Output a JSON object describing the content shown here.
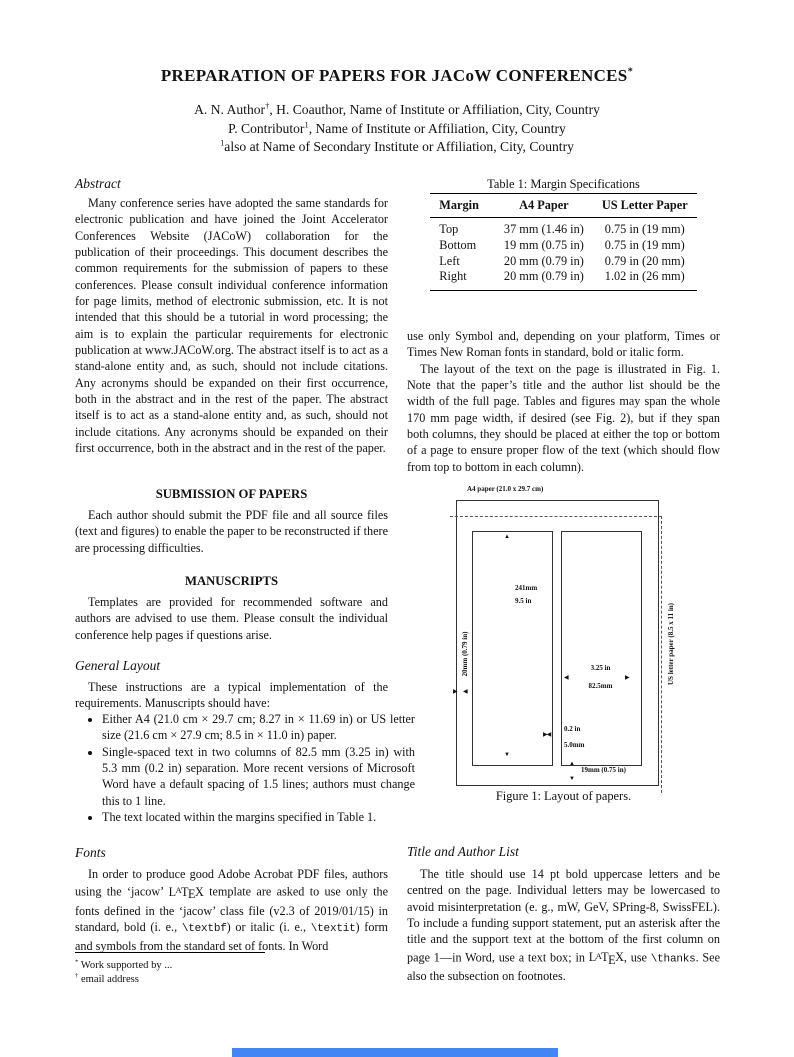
{
  "header": {
    "title": "PREPARATION OF PAPERS FOR JACoW CONFERENCES",
    "title_note": "*",
    "author_lines": [
      {
        "text": "A. N. Author",
        "sup": "†",
        "rest": ", H. Coauthor, Name of Institute or Affiliation, City, Country"
      },
      {
        "text": "P. Contributor",
        "sup": "1",
        "rest": ", Name of Institute or Affiliation, City, Country"
      },
      {
        "text": "",
        "sup": "1",
        "rest": "also at Name of Secondary Institute or Affiliation, City, Country"
      }
    ]
  },
  "left_column": {
    "abstract": {
      "heading": "Abstract",
      "body": "Many conference series have adopted the same standards for electronic publication and have joined the Joint Accelerator Conferences Website (JACoW) collaboration for the publication of their proceedings. This document describes the common requirements for the submission of papers to these conferences. Please consult individual conference information for page limits, method of electronic submission, etc. It is not intended that this should be a tutorial in word processing; the aim is to explain the particular requirements for electronic publication at www.JACoW.org. The abstract itself is to act as a stand-alone entity and, as such, should not include citations. Any acronyms should be expanded on their first occurrence, both in the abstract and in the rest of the paper. The abstract itself is to act as a stand-alone entity and, as such, should not include citations. Any acronyms should be expanded on their first occurrence, both in the abstract and in the rest of the paper."
    },
    "submission": {
      "heading": "SUBMISSION OF PAPERS",
      "body": "Each author should submit the PDF file and all source files (text and figures) to enable the paper to be reconstructed if there are processing difficulties."
    },
    "manuscripts": {
      "heading": "MANUSCRIPTS",
      "body": "Templates are provided for recommended software and authors are advised to use them. Please consult the individual conference help pages if questions arise."
    },
    "general_layout": {
      "heading": "General Layout",
      "intro": "These instructions are a typical implementation of the requirements. Manuscripts should have:",
      "bullets": [
        "Either A4 (21.0 cm × 29.7 cm; 8.27 in × 11.69 in) or US letter size (21.6 cm × 27.9 cm; 8.5 in × 11.0 in) paper.",
        "Single-spaced text in two columns of 82.5 mm (3.25 in) with 5.3 mm (0.2 in) separation. More recent versions of Microsoft Word have a default spacing of 1.5 lines; authors must change this to 1 line.",
        "The text located within the margins specified in Table 1."
      ]
    },
    "fonts": {
      "heading": "Fonts",
      "segments": [
        {
          "type": "text",
          "value": "In order to produce good Adobe Acrobat PDF files, authors using the ‘jacow’ "
        },
        {
          "type": "latex",
          "value": "LATEX"
        },
        {
          "type": "text",
          "value": " template are asked to use only the fonts defined in the ‘jacow’ class file (v2.3 of 2019/01/15) in standard, bold (i. e., "
        },
        {
          "type": "code",
          "value": "\\textbf"
        },
        {
          "type": "text",
          "value": ") or italic (i. e., "
        },
        {
          "type": "code",
          "value": "\\textit"
        },
        {
          "type": "text",
          "value": ") form and symbols from the standard set of fonts. In Word"
        }
      ]
    },
    "footnotes": [
      {
        "sup": "*",
        "text": "Work supported by ..."
      },
      {
        "sup": "†",
        "text": "email address"
      }
    ]
  },
  "right_column": {
    "table": {
      "caption": "Table 1: Margin Specifications",
      "headers": [
        "Margin",
        "A4 Paper",
        "US Letter Paper"
      ],
      "rows": [
        [
          "Top",
          "37 mm (1.46 in)",
          "0.75 in (19 mm)"
        ],
        [
          "Bottom",
          "19 mm (0.75 in)",
          "0.75 in (19 mm)"
        ],
        [
          "Left",
          "20 mm (0.79 in)",
          "0.79 in (20 mm)"
        ],
        [
          "Right",
          "20 mm (0.79 in)",
          "1.02 in (26 mm)"
        ]
      ]
    },
    "paragraph1": "use only Symbol and, depending on your platform, Times or Times New Roman fonts in standard, bold or italic form.",
    "paragraph2": "The layout of the text on the page is illustrated in Fig. 1. Note that the paper’s title and the author list should be the width of the full page. Tables and figures may span the whole 170 mm page width, if desired (see Fig. 2), but if they span both columns, they should be placed at either the top or bottom of a page to ensure proper flow of the text (which should flow from top to bottom in each column).",
    "figure": {
      "paper_label": "A4 paper (21.0 x 29.7 cm)",
      "column_height_mm": "241mm",
      "column_height_in": "9.5 in",
      "left_margin": "20mm (0.79 in)",
      "column_width_in": "3.25 in",
      "column_width_mm": "82.5mm",
      "gap_in": "0.2 in",
      "gap_mm": "5.0mm",
      "bottom_margin": "19mm (0.75 in)",
      "us_letter_label": "US letter paper (8.5 x 11 in)",
      "caption": "Figure 1: Layout of papers."
    },
    "title_author": {
      "heading": "Title and Author List",
      "segments": [
        {
          "type": "text",
          "value": "The title should use 14 pt bold uppercase letters and be centred on the page. Individual letters may be lowercased to avoid misinterpretation (e. g., mW, GeV, SPring-8, SwissFEL). To include a funding support statement, put an asterisk after the title and the support text at the bottom of the first column on page 1—in Word, use a text box; in "
        },
        {
          "type": "latex",
          "value": "LATEX"
        },
        {
          "type": "text",
          "value": ", use "
        },
        {
          "type": "code",
          "value": "\\thanks"
        },
        {
          "type": "text",
          "value": ". See also the subsection on footnotes."
        }
      ]
    }
  },
  "bottom_bar": {
    "color": "#4285f4"
  }
}
